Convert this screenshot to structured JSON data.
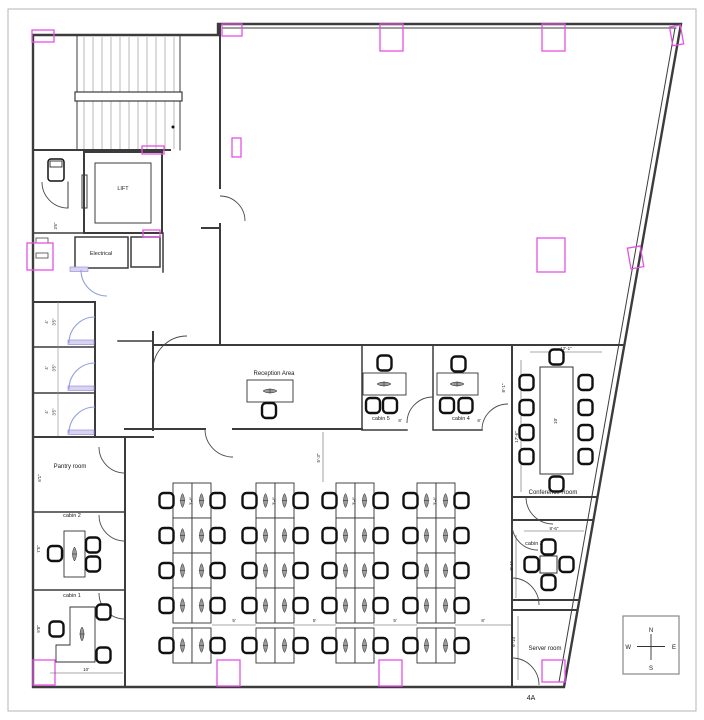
{
  "sheet": {
    "label": "4A"
  },
  "colors": {
    "wall": "#3c3c3c",
    "column": "#e452e4",
    "door_blue": "#8f9fdd"
  },
  "rooms": {
    "lift": {
      "label": "LIFT"
    },
    "electrical": {
      "label": "Electrical"
    },
    "reception": {
      "label": "Reception Area"
    },
    "pantry": {
      "label": "Pantry room",
      "dim_side": "6'1\""
    },
    "cabin1": {
      "label": "cabin 1",
      "dim_side": "9'8\"",
      "dim_front": "10'"
    },
    "cabin2": {
      "label": "cabin 2",
      "dim_side": "7'5\""
    },
    "cabin3": {
      "label": "cabin 3",
      "dim_top": "8'-6\"",
      "dim_side": "8'-1\""
    },
    "cabin4": {
      "label": "cabin 4",
      "dim": "8'",
      "dim_side": "8'-1\""
    },
    "cabin5": {
      "label": "cabin 5",
      "dim": "8'"
    },
    "conference": {
      "label": "Conference Room",
      "dim_top": "12'-1\"",
      "dim_side": "17'-6\"",
      "table_dim": "10'"
    },
    "server": {
      "label": "Server room",
      "dim_side": "6'-10\""
    },
    "toilets": {
      "stall_width": "4'",
      "stall_depth": "3'5\"",
      "wc_dim": "3'6\""
    }
  },
  "open_office": {
    "desk_dim": "3'-4\"",
    "aisle_dims": [
      "5'",
      "5'",
      "5'",
      "8'"
    ],
    "front_aisle_dim": "5'-3\""
  },
  "compass": {
    "north": "N",
    "south": "S",
    "east": "E",
    "west": "W"
  }
}
